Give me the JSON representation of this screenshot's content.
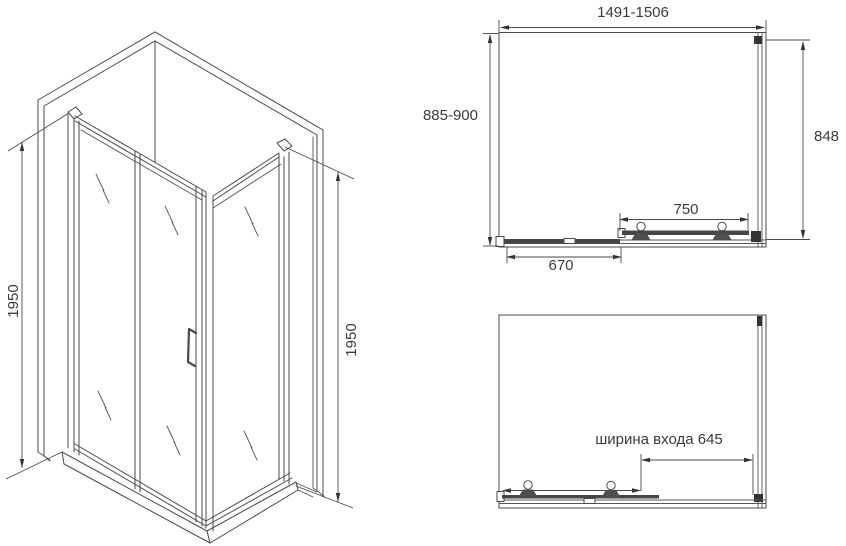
{
  "colors": {
    "background": "#ffffff",
    "line": "#4a4a4a",
    "text": "#3a3a3a"
  },
  "iso_view": {
    "height_left": "1950",
    "height_right": "1950"
  },
  "plan_closed": {
    "overall_width": "1491-1506",
    "depth": "885-900",
    "inner_depth": "848",
    "door_width": "750",
    "fixed_panel_width": "670"
  },
  "plan_open": {
    "entrance_width": "ширина входа 645"
  }
}
